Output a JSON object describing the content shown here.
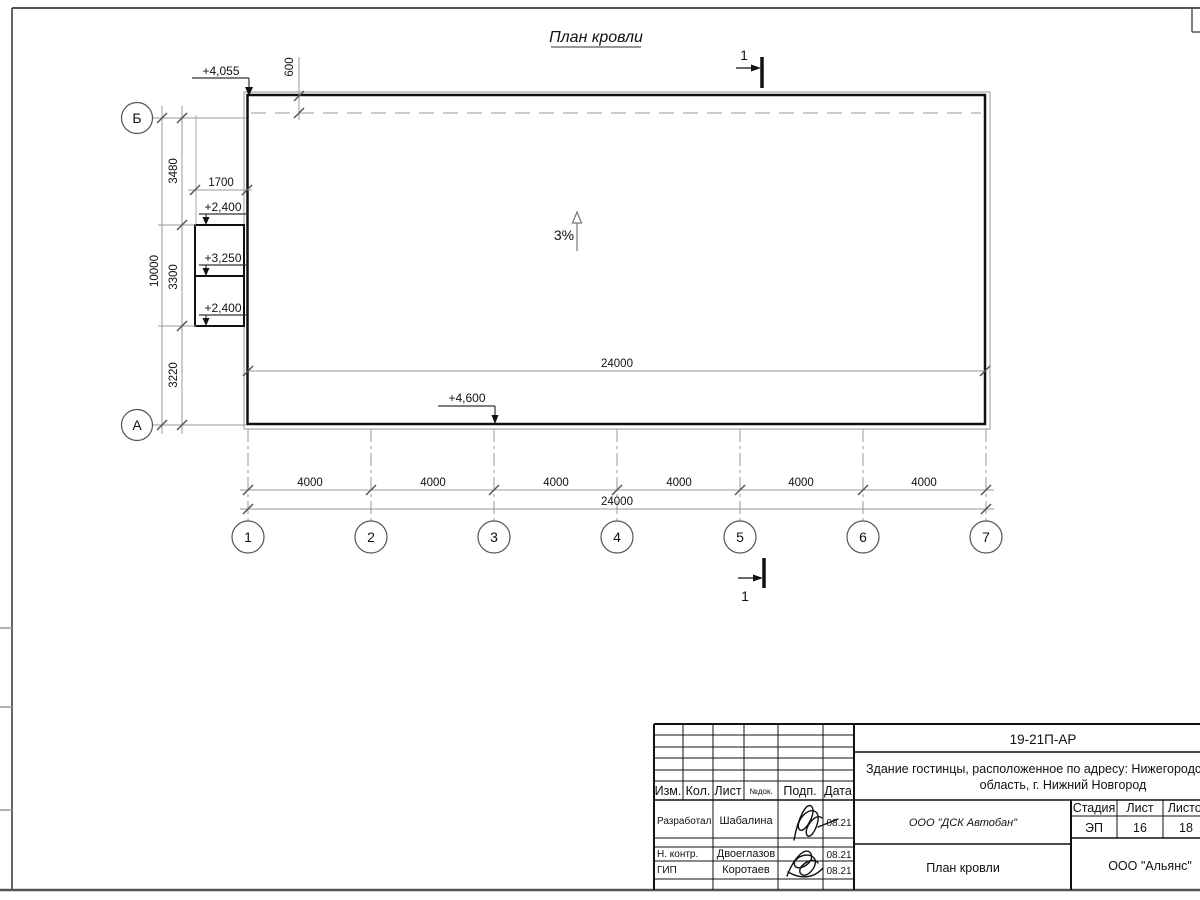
{
  "sheet": {
    "title": "План кровли"
  },
  "colors": {
    "ink": "#111111",
    "thin_line": "#8f8f8f",
    "dashed_line": "#b8b8b8"
  },
  "axes": {
    "cols": [
      "1",
      "2",
      "3",
      "4",
      "5",
      "6",
      "7"
    ],
    "rows": {
      "top": "Б",
      "bottom": "А"
    }
  },
  "dims": {
    "bottom_segments": [
      "4000",
      "4000",
      "4000",
      "4000",
      "4000",
      "4000"
    ],
    "bottom_total": "24000",
    "roof_inner_width": "24000",
    "left_segments": [
      "3480",
      "3300",
      "3220"
    ],
    "left_total": "10000",
    "porch_width": "1700",
    "parapet_offset": "600"
  },
  "elevations": {
    "top_left": "+4,055",
    "porch_upper": "+2,400",
    "porch_mid": "+3,250",
    "porch_lower": "+2,400",
    "roof_low": "+4,600"
  },
  "slope_label": "3%",
  "section_mark": "1",
  "title_block": {
    "doc_code": "19-21П-АР",
    "project_line1": "Здание гостинцы, расположенное по адресу: Нижегородская",
    "project_line2": "область, г. Нижний Новгород",
    "header": {
      "izm": "Изм.",
      "kol": "Кол.",
      "list": "Лист",
      "ndok": "№док.",
      "podp": "Подп.",
      "data": "Дата"
    },
    "stage_label": "Стадия",
    "sheet_label": "Лист",
    "sheets_label": "Листов",
    "stage": "ЭП",
    "sheet_no": "16",
    "sheets_total": "18",
    "roles": [
      {
        "role": "Разработал",
        "name": "Шабалина",
        "date": "08.21"
      },
      {
        "role": "Н. контр.",
        "name": "Двоеглазов",
        "date": "08.21"
      },
      {
        "role": "ГИП",
        "name": "Коротаев",
        "date": "08.21"
      }
    ],
    "company": "ООО \"ДСК Автобан\"",
    "drawing_title": "План кровли",
    "org": "ООО \"Альянс\""
  }
}
